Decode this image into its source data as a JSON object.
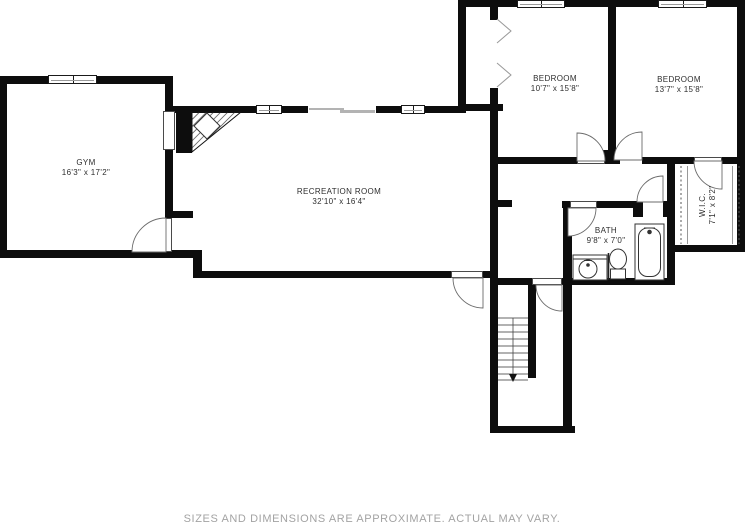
{
  "floor_plan": {
    "rooms": [
      {
        "id": "gym",
        "name": "GYM",
        "dims": "16'3\" x 17'2\""
      },
      {
        "id": "recreation",
        "name": "RECREATION ROOM",
        "dims": "32'10\" x 16'4\""
      },
      {
        "id": "bedroom1",
        "name": "BEDROOM",
        "dims": "10'7\" x 15'8\""
      },
      {
        "id": "bedroom2",
        "name": "BEDROOM",
        "dims": "13'7\" x 15'8\""
      },
      {
        "id": "bath",
        "name": "BATH",
        "dims": "9'8\" x 7'0\""
      },
      {
        "id": "wic",
        "name": "W.I.C.",
        "dims": "7'1\" x 8'2\""
      }
    ],
    "disclaimer": "SIZES AND DIMENSIONS ARE APPROXIMATE. ACTUAL MAY VARY.",
    "colors": {
      "wall": "#0d0d0d",
      "background": "#ffffff",
      "thin_line": "#555555",
      "disclaimer_text": "#a3a3a3"
    }
  }
}
